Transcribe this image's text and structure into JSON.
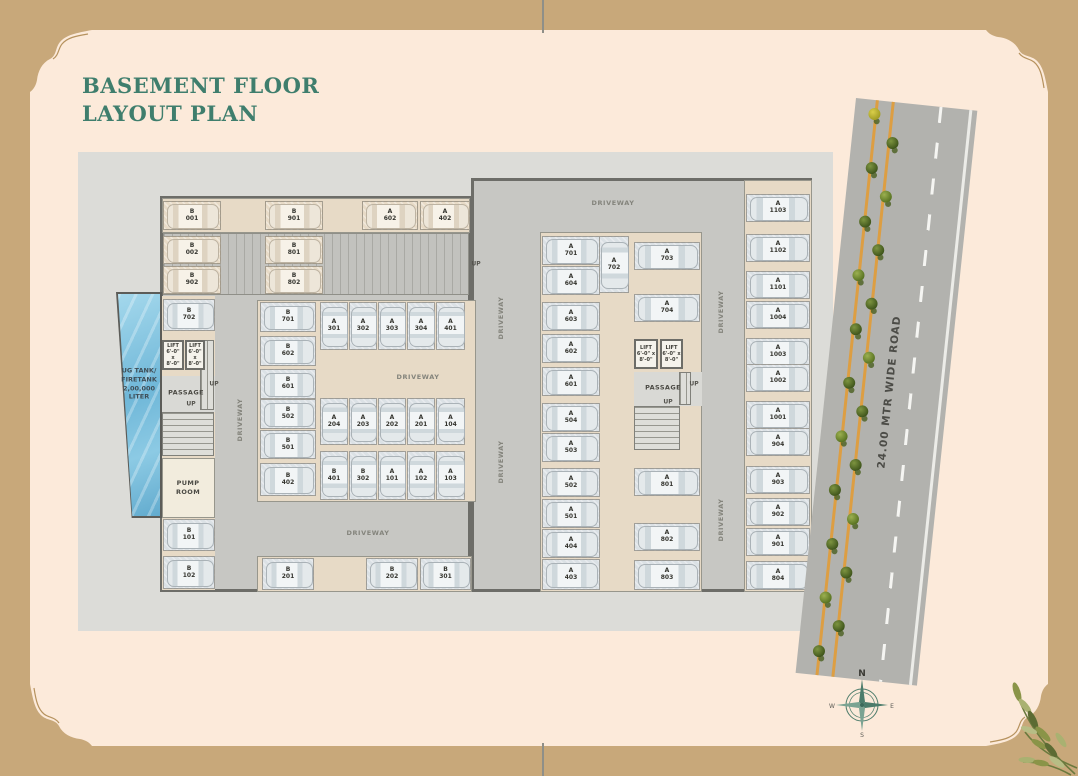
{
  "title": {
    "line1": "BASEMENT FLOOR",
    "line2": "LAYOUT PLAN"
  },
  "colors": {
    "page_bg": "#c8a87a",
    "panel_bg": "#fceada",
    "title_green": "#3f7e6d",
    "site_gray": "#dcdcd8",
    "driveway_gray": "#c7c7c3",
    "wall_gray": "#6d6d68",
    "parking_tan": "#e7dac6",
    "stall_blue": "#dbe1e5",
    "pool_blue": "#7ec3e0",
    "road_gray": "#b2b2ae",
    "road_line_orange": "#dd9e42",
    "tree_green": "#55701f"
  },
  "road": {
    "label": "24.00 MTR WIDE ROAD"
  },
  "compass": {
    "n": "N",
    "e": "E",
    "s": "S",
    "w": "W"
  },
  "labels": {
    "lift": "LIFT\n6'-0\" x\n8'-0\"",
    "passage": "PASSAGE",
    "pump_room": "PUMP\nROOM",
    "ug_tank": "UG TANK/\nFIRETANK\n2,00,000\nLITER",
    "driveway": "DRIVEWAY",
    "up": "UP"
  },
  "plan": {
    "spaces": [
      {
        "l": "B 001",
        "x": 163,
        "y": 201,
        "w": 58,
        "h": 29,
        "o": "h",
        "t": "tan"
      },
      {
        "l": "B 901",
        "x": 265,
        "y": 201,
        "w": 58,
        "h": 29,
        "o": "h",
        "t": "tan"
      },
      {
        "l": "A 602",
        "x": 362,
        "y": 201,
        "w": 56,
        "h": 29,
        "o": "h",
        "t": "tan"
      },
      {
        "l": "A 402",
        "x": 420,
        "y": 201,
        "w": 50,
        "h": 29,
        "o": "h",
        "t": "tan"
      },
      {
        "l": "B 002",
        "x": 163,
        "y": 236,
        "w": 58,
        "h": 28,
        "o": "h",
        "t": "tan"
      },
      {
        "l": "B 801",
        "x": 265,
        "y": 236,
        "w": 58,
        "h": 28,
        "o": "h",
        "t": "tan"
      },
      {
        "l": "B 902",
        "x": 163,
        "y": 266,
        "w": 58,
        "h": 28,
        "o": "h",
        "t": "tan"
      },
      {
        "l": "B 802",
        "x": 265,
        "y": 266,
        "w": 58,
        "h": 28,
        "o": "h",
        "t": "tan"
      },
      {
        "l": "B 702",
        "x": 163,
        "y": 299,
        "w": 52,
        "h": 32,
        "o": "h",
        "t": "blue"
      },
      {
        "l": "B 101",
        "x": 163,
        "y": 519,
        "w": 52,
        "h": 32,
        "o": "h",
        "t": "blue"
      },
      {
        "l": "B 102",
        "x": 163,
        "y": 556,
        "w": 52,
        "h": 33,
        "o": "h",
        "t": "blue"
      },
      {
        "l": "B 701",
        "x": 260,
        "y": 302,
        "w": 56,
        "h": 30,
        "o": "h",
        "t": "blue"
      },
      {
        "l": "B 602",
        "x": 260,
        "y": 336,
        "w": 56,
        "h": 30,
        "o": "h",
        "t": "blue"
      },
      {
        "l": "B 601",
        "x": 260,
        "y": 369,
        "w": 56,
        "h": 30,
        "o": "h",
        "t": "blue"
      },
      {
        "l": "B 502",
        "x": 260,
        "y": 399,
        "w": 56,
        "h": 30,
        "o": "h",
        "t": "blue"
      },
      {
        "l": "B 501",
        "x": 260,
        "y": 430,
        "w": 56,
        "h": 29,
        "o": "h",
        "t": "blue"
      },
      {
        "l": "B 402",
        "x": 260,
        "y": 463,
        "w": 56,
        "h": 33,
        "o": "h",
        "t": "blue"
      },
      {
        "l": "A 301",
        "x": 320,
        "y": 302,
        "w": 28,
        "h": 48,
        "o": "v",
        "t": "blue"
      },
      {
        "l": "A 302",
        "x": 349,
        "y": 302,
        "w": 28,
        "h": 48,
        "o": "v",
        "t": "blue"
      },
      {
        "l": "A 303",
        "x": 378,
        "y": 302,
        "w": 28,
        "h": 48,
        "o": "v",
        "t": "blue"
      },
      {
        "l": "A 304",
        "x": 407,
        "y": 302,
        "w": 28,
        "h": 48,
        "o": "v",
        "t": "blue"
      },
      {
        "l": "A 401",
        "x": 436,
        "y": 302,
        "w": 29,
        "h": 48,
        "o": "v",
        "t": "blue"
      },
      {
        "l": "A 204",
        "x": 320,
        "y": 398,
        "w": 28,
        "h": 47,
        "o": "v",
        "t": "blue"
      },
      {
        "l": "A 203",
        "x": 349,
        "y": 398,
        "w": 28,
        "h": 47,
        "o": "v",
        "t": "blue"
      },
      {
        "l": "A 202",
        "x": 378,
        "y": 398,
        "w": 28,
        "h": 47,
        "o": "v",
        "t": "blue"
      },
      {
        "l": "A 201",
        "x": 407,
        "y": 398,
        "w": 28,
        "h": 47,
        "o": "v",
        "t": "blue"
      },
      {
        "l": "A 104",
        "x": 436,
        "y": 398,
        "w": 29,
        "h": 47,
        "o": "v",
        "t": "blue"
      },
      {
        "l": "B 401",
        "x": 320,
        "y": 451,
        "w": 28,
        "h": 49,
        "o": "v",
        "t": "blue"
      },
      {
        "l": "B 302",
        "x": 349,
        "y": 451,
        "w": 28,
        "h": 49,
        "o": "v",
        "t": "blue"
      },
      {
        "l": "A 101",
        "x": 378,
        "y": 451,
        "w": 28,
        "h": 49,
        "o": "v",
        "t": "blue"
      },
      {
        "l": "A 102",
        "x": 407,
        "y": 451,
        "w": 28,
        "h": 49,
        "o": "v",
        "t": "blue"
      },
      {
        "l": "A 103",
        "x": 436,
        "y": 451,
        "w": 29,
        "h": 49,
        "o": "v",
        "t": "blue"
      },
      {
        "l": "B 201",
        "x": 262,
        "y": 558,
        "w": 52,
        "h": 32,
        "o": "h",
        "t": "blue"
      },
      {
        "l": "B 202",
        "x": 366,
        "y": 558,
        "w": 52,
        "h": 32,
        "o": "h",
        "t": "blue"
      },
      {
        "l": "B 301",
        "x": 420,
        "y": 558,
        "w": 51,
        "h": 32,
        "o": "h",
        "t": "blue"
      },
      {
        "l": "A 701",
        "x": 542,
        "y": 236,
        "w": 58,
        "h": 29,
        "o": "h",
        "t": "blue"
      },
      {
        "l": "A 604",
        "x": 542,
        "y": 266,
        "w": 58,
        "h": 29,
        "o": "h",
        "t": "blue"
      },
      {
        "l": "A 603",
        "x": 542,
        "y": 302,
        "w": 58,
        "h": 29,
        "o": "h",
        "t": "blue"
      },
      {
        "l": "A 602",
        "x": 542,
        "y": 334,
        "w": 58,
        "h": 29,
        "o": "h",
        "t": "blue"
      },
      {
        "l": "A 601",
        "x": 542,
        "y": 367,
        "w": 58,
        "h": 29,
        "o": "h",
        "t": "blue"
      },
      {
        "l": "A 504",
        "x": 542,
        "y": 403,
        "w": 58,
        "h": 29,
        "o": "h",
        "t": "blue"
      },
      {
        "l": "A 503",
        "x": 542,
        "y": 433,
        "w": 58,
        "h": 29,
        "o": "h",
        "t": "blue"
      },
      {
        "l": "A 502",
        "x": 542,
        "y": 468,
        "w": 58,
        "h": 29,
        "o": "h",
        "t": "blue"
      },
      {
        "l": "A 501",
        "x": 542,
        "y": 499,
        "w": 58,
        "h": 29,
        "o": "h",
        "t": "blue"
      },
      {
        "l": "A 404",
        "x": 542,
        "y": 529,
        "w": 58,
        "h": 29,
        "o": "h",
        "t": "blue"
      },
      {
        "l": "A 403",
        "x": 542,
        "y": 559,
        "w": 58,
        "h": 31,
        "o": "h",
        "t": "blue"
      },
      {
        "l": "A 702",
        "x": 599,
        "y": 236,
        "w": 30,
        "h": 57,
        "o": "v",
        "t": "blue"
      },
      {
        "l": "A 703",
        "x": 634,
        "y": 242,
        "w": 66,
        "h": 28,
        "o": "h",
        "t": "blue"
      },
      {
        "l": "A 704",
        "x": 634,
        "y": 294,
        "w": 66,
        "h": 28,
        "o": "h",
        "t": "blue"
      },
      {
        "l": "A 801",
        "x": 634,
        "y": 468,
        "w": 66,
        "h": 28,
        "o": "h",
        "t": "blue"
      },
      {
        "l": "A 802",
        "x": 634,
        "y": 523,
        "w": 66,
        "h": 28,
        "o": "h",
        "t": "blue"
      },
      {
        "l": "A 803",
        "x": 634,
        "y": 560,
        "w": 66,
        "h": 30,
        "o": "h",
        "t": "blue"
      },
      {
        "l": "A 1103",
        "x": 746,
        "y": 194,
        "w": 64,
        "h": 28,
        "o": "h",
        "t": "blue"
      },
      {
        "l": "A 1102",
        "x": 746,
        "y": 234,
        "w": 64,
        "h": 28,
        "o": "h",
        "t": "blue"
      },
      {
        "l": "A 1101",
        "x": 746,
        "y": 271,
        "w": 64,
        "h": 28,
        "o": "h",
        "t": "blue"
      },
      {
        "l": "A 1004",
        "x": 746,
        "y": 301,
        "w": 64,
        "h": 28,
        "o": "h",
        "t": "blue"
      },
      {
        "l": "A 1003",
        "x": 746,
        "y": 338,
        "w": 64,
        "h": 28,
        "o": "h",
        "t": "blue"
      },
      {
        "l": "A 1002",
        "x": 746,
        "y": 364,
        "w": 64,
        "h": 28,
        "o": "h",
        "t": "blue"
      },
      {
        "l": "A 1001",
        "x": 746,
        "y": 401,
        "w": 64,
        "h": 28,
        "o": "h",
        "t": "blue"
      },
      {
        "l": "A 904",
        "x": 746,
        "y": 428,
        "w": 64,
        "h": 28,
        "o": "h",
        "t": "blue"
      },
      {
        "l": "A 903",
        "x": 746,
        "y": 466,
        "w": 64,
        "h": 28,
        "o": "h",
        "t": "blue"
      },
      {
        "l": "A 902",
        "x": 746,
        "y": 498,
        "w": 64,
        "h": 28,
        "o": "h",
        "t": "blue"
      },
      {
        "l": "A 901",
        "x": 746,
        "y": 528,
        "w": 64,
        "h": 28,
        "o": "h",
        "t": "blue"
      },
      {
        "l": "A 804",
        "x": 746,
        "y": 561,
        "w": 64,
        "h": 29,
        "o": "h",
        "t": "blue"
      }
    ],
    "texts": [
      {
        "t": "DRIVEWAY",
        "x": 613,
        "y": 203,
        "cls": "dtext",
        "name": "driveway-label"
      },
      {
        "t": "DRIVEWAY",
        "x": 240,
        "y": 420,
        "cls": "dtext r",
        "name": "driveway-label"
      },
      {
        "t": "DRIVEWAY",
        "x": 418,
        "y": 377,
        "cls": "dtext",
        "name": "driveway-label"
      },
      {
        "t": "DRIVEWAY",
        "x": 368,
        "y": 533,
        "cls": "dtext",
        "name": "driveway-label"
      },
      {
        "t": "DRIVEWAY",
        "x": 501,
        "y": 318,
        "cls": "dtext r",
        "name": "driveway-label"
      },
      {
        "t": "DRIVEWAY",
        "x": 501,
        "y": 462,
        "cls": "dtext r",
        "name": "driveway-label"
      },
      {
        "t": "DRIVEWAY",
        "x": 721,
        "y": 312,
        "cls": "dtext r",
        "name": "driveway-label"
      },
      {
        "t": "DRIVEWAY",
        "x": 721,
        "y": 520,
        "cls": "dtext r",
        "name": "driveway-label"
      },
      {
        "t": "UP",
        "x": 476,
        "y": 264,
        "cls": "up",
        "name": "up-label"
      },
      {
        "t": "UP",
        "x": 214,
        "y": 384,
        "cls": "up",
        "name": "up-label"
      },
      {
        "t": "UP",
        "x": 191,
        "y": 404,
        "cls": "up",
        "name": "up-label"
      },
      {
        "t": "UP",
        "x": 694,
        "y": 384,
        "cls": "up",
        "name": "up-label"
      },
      {
        "t": "UP",
        "x": 668,
        "y": 402,
        "cls": "up",
        "name": "up-label"
      },
      {
        "t": "PASSAGE",
        "x": 186,
        "y": 393,
        "cls": "room",
        "name": "passage-label"
      },
      {
        "t": "PASSAGE",
        "x": 663,
        "y": 388,
        "cls": "room",
        "name": "passage-label"
      },
      {
        "t": "PUMP\nROOM",
        "x": 188,
        "y": 488,
        "cls": "room",
        "name": "pump-room-label"
      },
      {
        "t": "UG TANK/\nFIRETANK\n2,00,000\nLITER",
        "x": 139,
        "y": 384,
        "cls": "tank",
        "name": "ug-tank-label"
      }
    ],
    "lifts": [
      {
        "x": 162,
        "y": 340,
        "w": 22,
        "h": 30
      },
      {
        "x": 185,
        "y": 340,
        "w": 20,
        "h": 30
      },
      {
        "x": 634,
        "y": 339,
        "w": 24,
        "h": 30
      },
      {
        "x": 660,
        "y": 339,
        "w": 23,
        "h": 30
      }
    ]
  }
}
